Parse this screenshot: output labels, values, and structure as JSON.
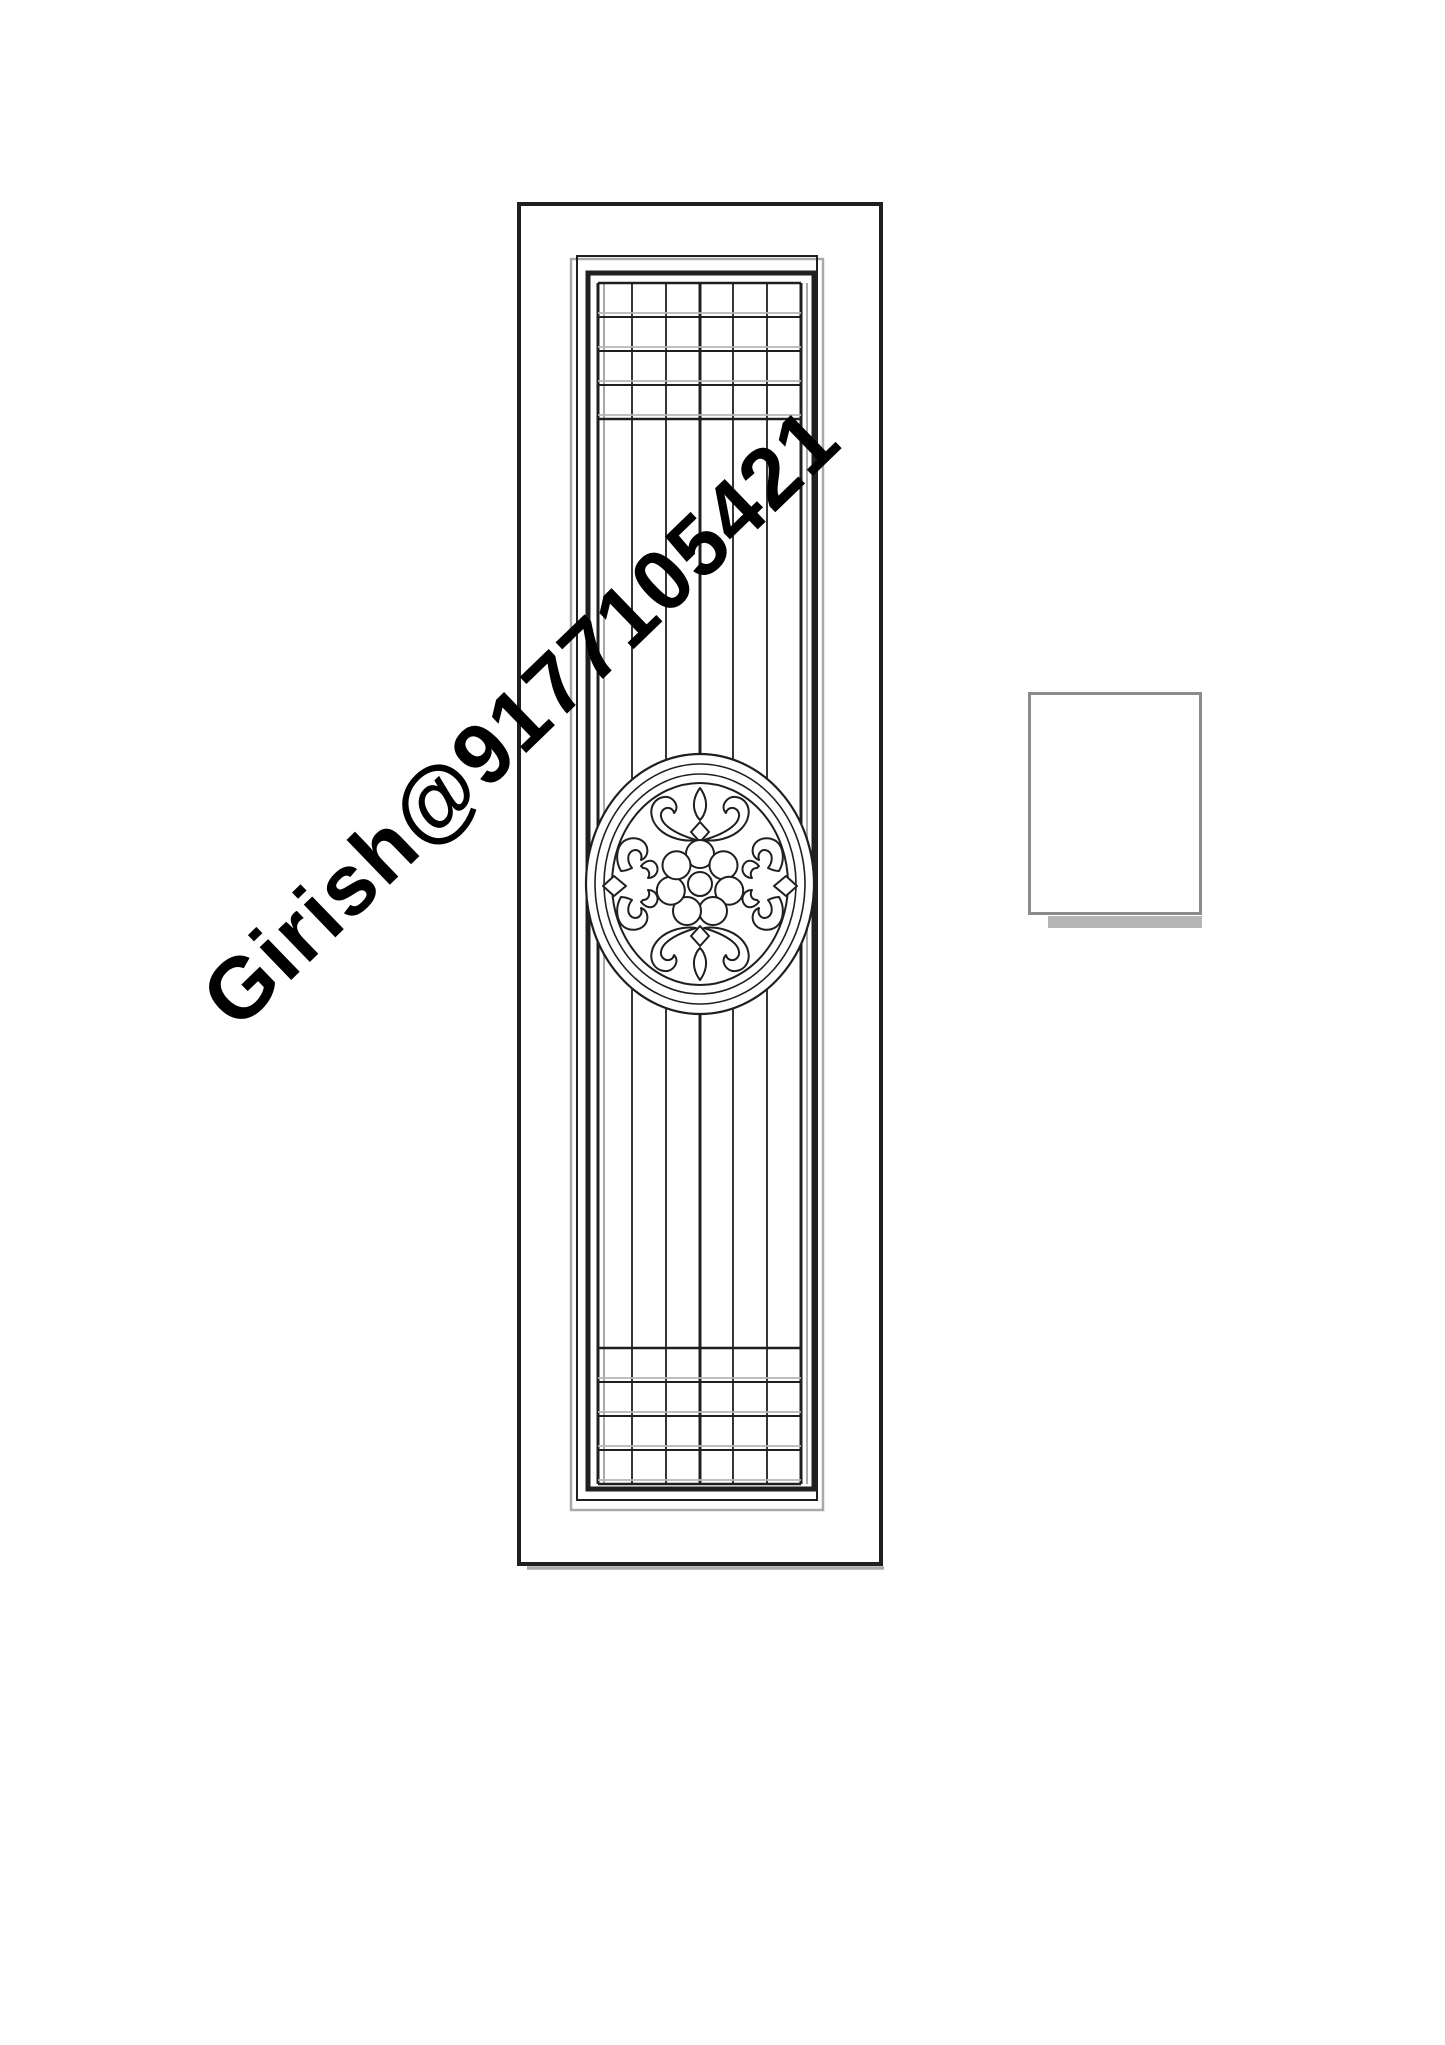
{
  "page": {
    "background": "#ffffff"
  },
  "watermark": {
    "text": "Girish@9177105421",
    "color": "#000000",
    "rotation_deg": -44,
    "font_size_px": 86
  },
  "drawing": {
    "line_color": "#1f1f1f",
    "soft_gray": "#a9a9a9",
    "grid_shadow_gray": "#b6b6b6",
    "door": {
      "outer_rect": {
        "x": 519,
        "y": 204,
        "w": 362,
        "h": 1360,
        "sw": 4
      },
      "outer_bottom_shadow": {
        "x1": 527,
        "x2": 884,
        "y": 1568,
        "sw": 3.5
      },
      "mid_gray_rect": {
        "x": 571,
        "y": 259,
        "w": 252,
        "h": 1251,
        "sw": 2.5
      },
      "mid_black_rect": {
        "x": 577,
        "y": 256,
        "w": 240,
        "h": 1244,
        "sw": 2
      },
      "inner_rect": {
        "x": 588,
        "y": 273,
        "w": 226,
        "h": 1216,
        "sw": 5
      },
      "grille": {
        "x_left": 598,
        "x_right": 801,
        "y_top": 283,
        "y_bottom": 1484,
        "verticals": [
          598,
          632,
          666,
          700,
          733,
          767,
          801
        ],
        "thick_verticals": [
          598,
          700,
          801
        ],
        "gray_verticals": [
          604,
          807
        ],
        "top_horizontals": [
          283,
          317,
          351,
          385,
          419
        ],
        "bottom_horizontals": [
          1348,
          1382,
          1416,
          1450,
          1484
        ]
      },
      "medallion": {
        "cx": 700,
        "cy": 884,
        "rings": [
          {
            "rx": 114,
            "ry": 130,
            "sw": 2.2
          },
          {
            "rx": 105,
            "ry": 120,
            "sw": 1.6
          },
          {
            "rx": 96,
            "ry": 110,
            "sw": 1.6
          },
          {
            "rx": 88,
            "ry": 101,
            "sw": 2
          }
        ],
        "flower": {
          "petal_count": 7,
          "petal_radius": 14,
          "orbit_radius": 30,
          "center_radius": 12,
          "start_angle_deg": -90
        }
      }
    },
    "side_panel": {
      "rect": {
        "x": 1028,
        "y": 692,
        "w": 174,
        "h": 223,
        "border_color": "#8c8c8c",
        "border_w": 3,
        "fill": "#ffffff"
      },
      "shadow": {
        "x": 1048,
        "y": 916,
        "w": 154,
        "h": 12,
        "color": "#b5b5b5"
      }
    }
  }
}
